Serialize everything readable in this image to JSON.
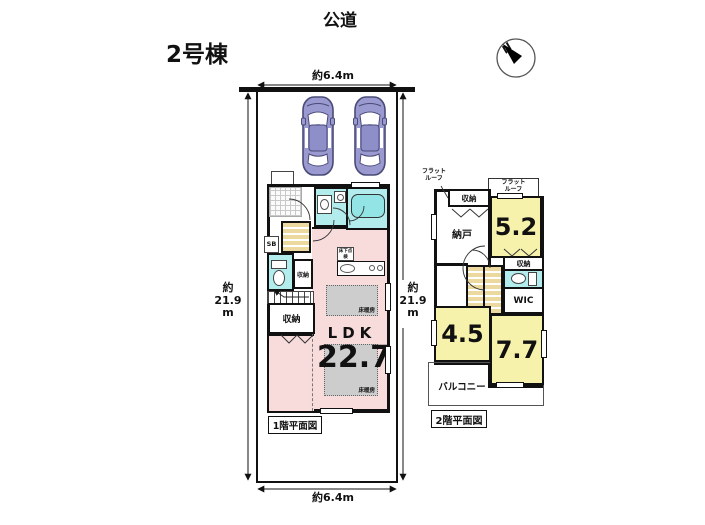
{
  "page": {
    "title": "2号棟",
    "road_label": "公道",
    "compass_north": "N"
  },
  "dimensions": {
    "top_width": "約6.4m",
    "bottom_width": "約6.4m",
    "left_height": "約\n21.9\nm",
    "right_height": "約\n21.9\nm"
  },
  "floor1": {
    "caption": "1階平面図",
    "ldk_label": "LDK",
    "ldk_area": "22.7",
    "floor_heating": "床暖房",
    "underfloor_access": "床下点検",
    "shoe_box": "SB",
    "toilet_storage": "収納",
    "closet": "収納"
  },
  "floor2": {
    "caption": "2階平面図",
    "flat_roof": "フラット\nルーフ",
    "storage_top": "収納",
    "storage_mid": "収納",
    "storeroom": "納戸",
    "room_west_area": "5.2",
    "room_south_area": "4.5",
    "room_east_area": "7.7",
    "wic": "WIC",
    "balcony": "バルコニー"
  },
  "colors": {
    "ldk_pink": "#f8dcdc",
    "room_yellow": "#f6f2ab",
    "wet_area_cyan": "#b2ecec",
    "stair_tan": "#ecd9a0",
    "floor_heating_gray": "#cdcdcd",
    "car_body": "#9a9ad0",
    "wall": "#111111"
  }
}
